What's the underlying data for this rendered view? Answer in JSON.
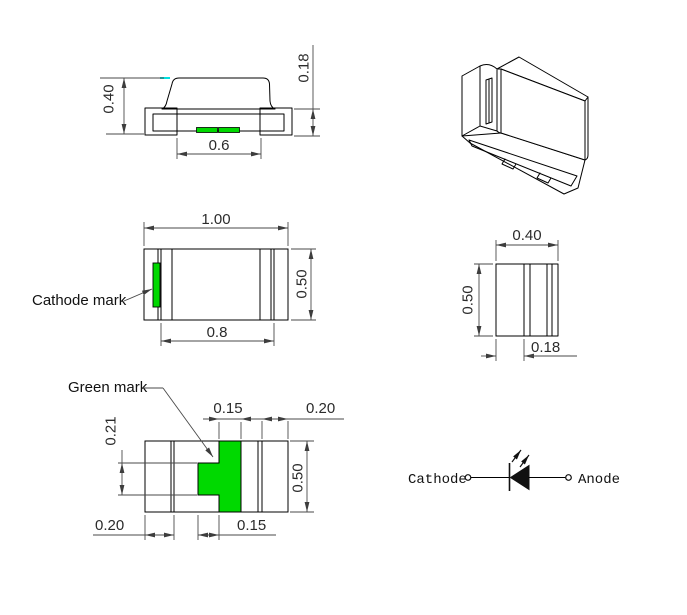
{
  "title": "SMD chip LED package outline drawing",
  "colors": {
    "yellow": "#ffff00",
    "green": "#00d900",
    "cyan": "#00e0e0",
    "line": "#000000",
    "dim_line": "#4a4a4a"
  },
  "side_view": {
    "dim_height": "0.40",
    "dim_terminal": "0.18",
    "dim_span": "0.6"
  },
  "top_view": {
    "dim_width": "1.00",
    "dim_height": "0.50",
    "dim_body": "0.8",
    "label_cathode": "Cathode mark"
  },
  "end_view": {
    "dim_width": "0.40",
    "dim_height": "0.50",
    "dim_terminal": "0.18"
  },
  "bottom_view": {
    "label_green": "Green mark",
    "dim_mark_w": "0.15",
    "dim_term_r": "0.20",
    "dim_notch_h": "0.21",
    "dim_height": "0.50",
    "dim_term_l": "0.20",
    "dim_tab_w": "0.15"
  },
  "symbol": {
    "cathode_label": "Cathode",
    "anode_label": "Anode"
  }
}
